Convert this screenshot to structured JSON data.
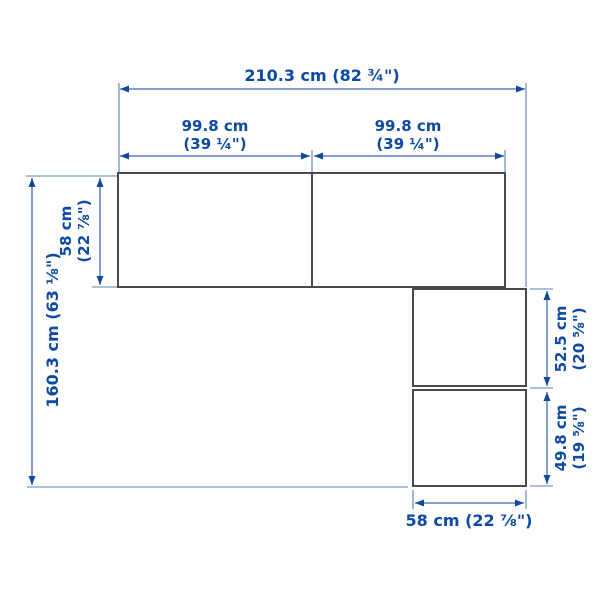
{
  "diagram": {
    "description": "Corner wardrobe combination dimension drawing, top view",
    "colors": {
      "dimension_text_blue": "#0d4aa3",
      "dimension_line_blue": "#3d68b0",
      "outline_gray": "#4a4a4a",
      "background": "#ffffff"
    },
    "dimensions": {
      "total_width": {
        "label": "210.3 cm (82 ¾\")"
      },
      "left_section_width": {
        "line1": "99.8 cm",
        "line2": "(39 ¼\")"
      },
      "right_section_width": {
        "line1": "99.8 cm",
        "line2": "(39 ¼\")"
      },
      "top_depth": {
        "line1": "58 cm",
        "line2": "(22 ⅞\")"
      },
      "total_depth": {
        "label": "160.3 cm (63 ⅛\")"
      },
      "right_upper_height": {
        "line1": "52.5 cm",
        "line2": "(20 ⅝\")"
      },
      "right_lower_height": {
        "line1": "49.8 cm",
        "line2": "(19 ⅝\")"
      },
      "bottom_depth": {
        "label": "58 cm (22 ⅞\")"
      }
    }
  }
}
